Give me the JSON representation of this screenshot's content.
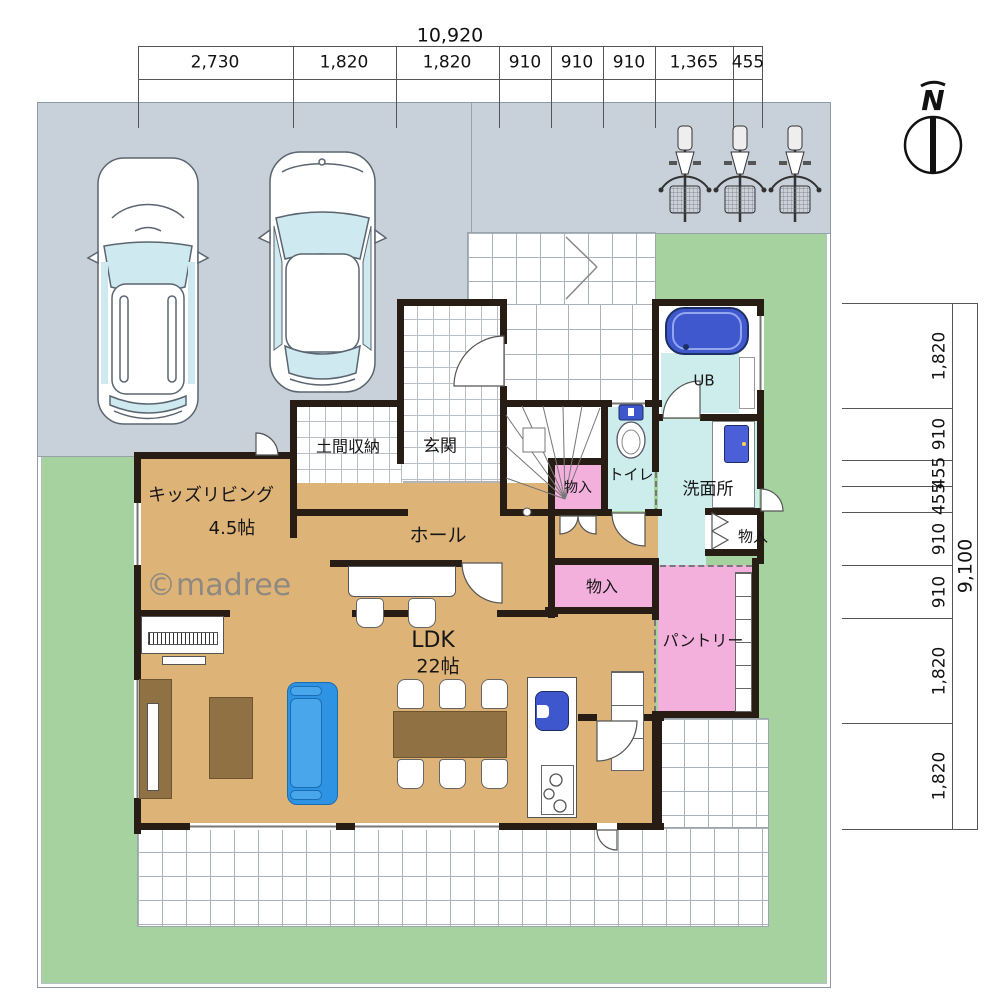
{
  "palette": {
    "yard_green": "#a6d29f",
    "parking_gray": "#c8d0d9",
    "wood_floor": "#deb377",
    "storage_pink": "#f3b0dc",
    "wet_cyan": "#cdeded",
    "fixture_blue": "#3f57cc",
    "sofa_blue": "#2d93e2",
    "wall_dark": "#281d15",
    "furniture_brown": "#8f7144"
  },
  "dimensions": {
    "top": {
      "total": "10,920",
      "segments": [
        "2,730",
        "1,820",
        "1,820",
        "910",
        "910",
        "910",
        "1,365",
        "455"
      ]
    },
    "right": {
      "total": "9,100",
      "segments": [
        "1,820",
        "910",
        "455",
        "455",
        "910",
        "910",
        "1,820",
        "1,820"
      ]
    }
  },
  "compass": {
    "label": "N"
  },
  "watermark": {
    "text": "©madree"
  },
  "rooms": {
    "doma": "土間収納",
    "genkan": "玄関",
    "kids_living": "キッズリビング",
    "kids_living_size": "4.5帖",
    "hall": "ホール",
    "ldk": "LDK",
    "ldk_size": "22帖",
    "pantry": "パントリー",
    "washroom": "洗面所",
    "toilet": "トイレ",
    "bath": "UB",
    "storage": "物入"
  }
}
